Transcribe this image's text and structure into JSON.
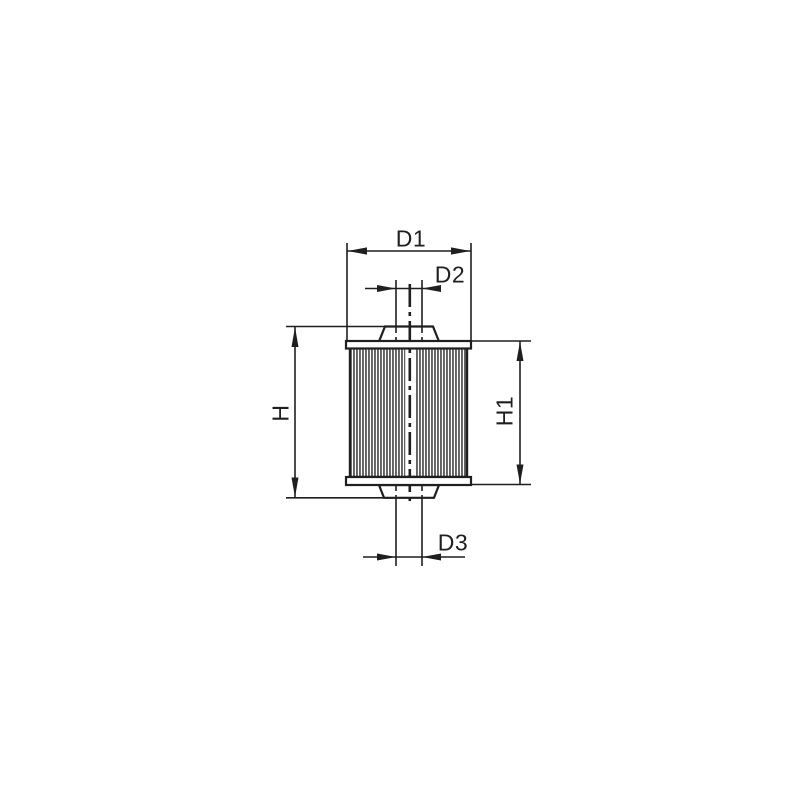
{
  "diagram": {
    "labels": {
      "d1": "D1",
      "d2": "D2",
      "d3": "D3",
      "h": "H",
      "h1": "H1"
    },
    "colors": {
      "ink": "#1f1f1f",
      "paper": "#ffffff"
    }
  }
}
